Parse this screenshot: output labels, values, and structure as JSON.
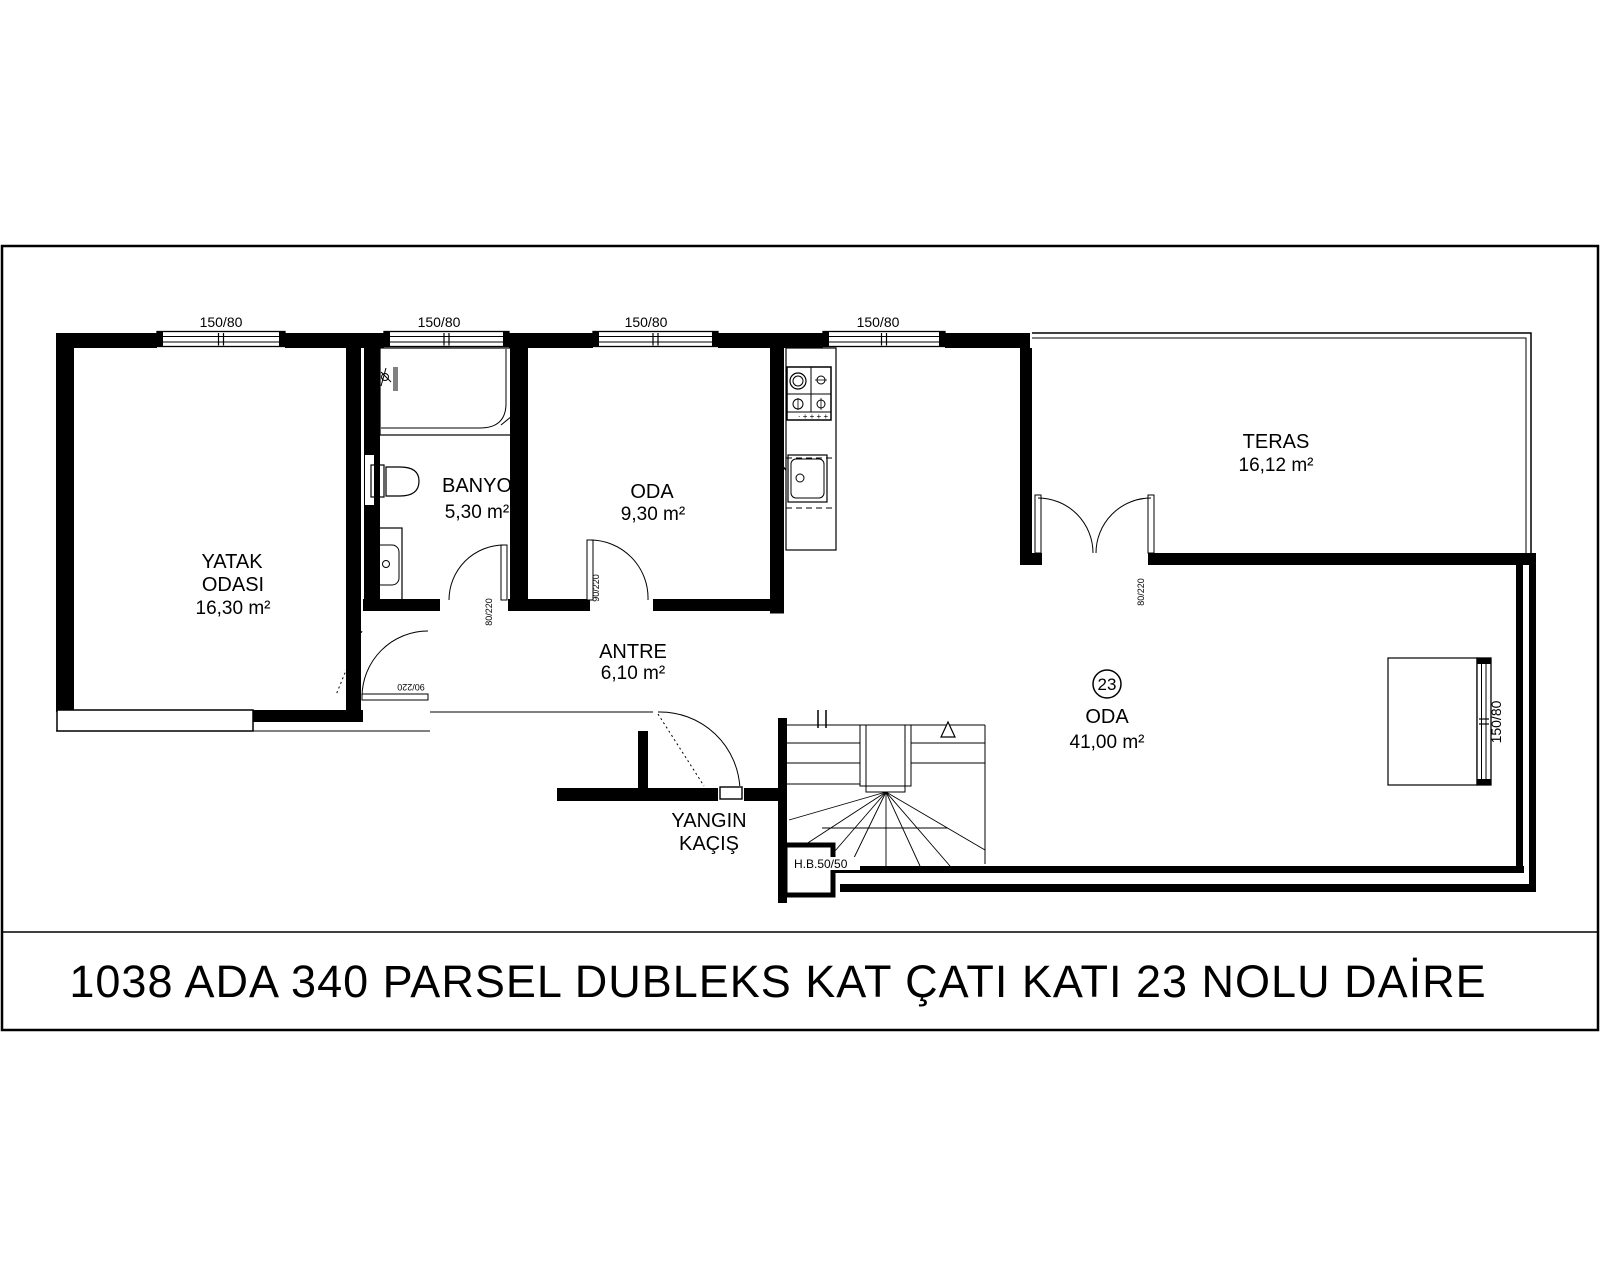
{
  "title": "1038 ADA 340 PARSEL  DUBLEKS KAT ÇATI KATI 23 NOLU DAİRE",
  "windows": {
    "top": [
      {
        "label": "150/80"
      },
      {
        "label": "150/80"
      },
      {
        "label": "150/80"
      },
      {
        "label": "150/80"
      }
    ],
    "right": {
      "label": "150/80"
    }
  },
  "rooms": {
    "bedroom": {
      "name_line1": "YATAK",
      "name_line2": "ODASI",
      "area": "16,30 m²"
    },
    "bath": {
      "name": "BANYO",
      "area": "5,30 m²"
    },
    "oda_small": {
      "name": "ODA",
      "area": "9,30 m²"
    },
    "antre": {
      "name": "ANTRE",
      "area": "6,10 m²"
    },
    "teras": {
      "name": "TERAS",
      "area": "16,12 m²"
    },
    "oda_big": {
      "name": "ODA",
      "area": "41,00 m²",
      "unit_number": "23"
    }
  },
  "fire_escape": {
    "line1": "YANGIN",
    "line2": "KAÇIŞ"
  },
  "hb_box": {
    "label": "H.B.50/50"
  },
  "door_labels": {
    "bedroom_door": "90/220",
    "bath_door": "80/220",
    "oda_door": "90/220",
    "teras_door_left": "80/220",
    "teras_door_right": "80/220"
  },
  "colors": {
    "line": "#000000",
    "background": "#ffffff",
    "shower_bar": "#808080"
  }
}
